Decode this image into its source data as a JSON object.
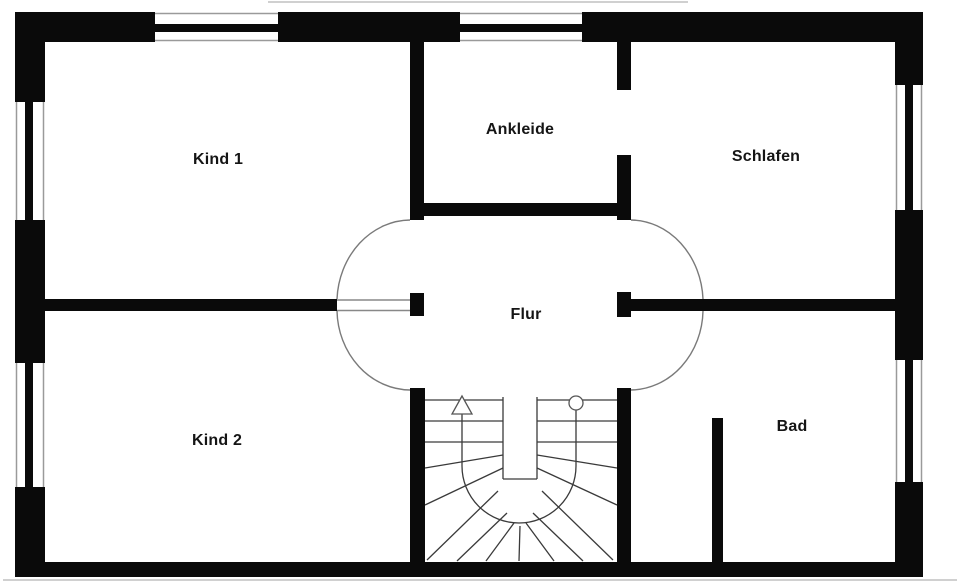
{
  "colors": {
    "wall": "#0a0a0a",
    "background": "#ffffff",
    "stair_line": "#3a3a3a",
    "arc_line": "#7a7a7a",
    "window_face": "#9a9a9a",
    "doorway_line": "#888888",
    "artifact": "#d0d0d0",
    "label": "#151515"
  },
  "rooms": [
    {
      "id": "kind-1",
      "label": "Kind 1",
      "cx": 218,
      "cy": 160
    },
    {
      "id": "ankleide",
      "label": "Ankleide",
      "cx": 520,
      "cy": 130
    },
    {
      "id": "schlafen",
      "label": "Schlafen",
      "cx": 766,
      "cy": 157
    },
    {
      "id": "flur",
      "label": "Flur",
      "cx": 526,
      "cy": 315
    },
    {
      "id": "kind-2",
      "label": "Kind 2",
      "cx": 217,
      "cy": 441
    },
    {
      "id": "bad",
      "label": "Bad",
      "cx": 792,
      "cy": 427
    }
  ],
  "walls": [
    {
      "id": "outer-top",
      "x": 15,
      "y": 12,
      "w": 908,
      "h": 30
    },
    {
      "id": "outer-left",
      "x": 15,
      "y": 12,
      "w": 30,
      "h": 565
    },
    {
      "id": "outer-right",
      "x": 895,
      "y": 12,
      "w": 28,
      "h": 565
    },
    {
      "id": "outer-bottom",
      "x": 15,
      "y": 562,
      "w": 908,
      "h": 15
    },
    {
      "id": "kind1-ankleide",
      "x": 410,
      "y": 42,
      "w": 14,
      "h": 178
    },
    {
      "id": "ankleide-schlafen-upper",
      "x": 617,
      "y": 42,
      "w": 14,
      "h": 48
    },
    {
      "id": "ankleide-schlafen-lower",
      "x": 617,
      "y": 155,
      "w": 14,
      "h": 65
    },
    {
      "id": "ankleide-bottom",
      "x": 424,
      "y": 203,
      "w": 207,
      "h": 13
    },
    {
      "id": "mid-left",
      "x": 45,
      "y": 299,
      "w": 292,
      "h": 12
    },
    {
      "id": "left-door-stub",
      "x": 410,
      "y": 293,
      "w": 14,
      "h": 23
    },
    {
      "id": "mid-right",
      "x": 617,
      "y": 299,
      "w": 278,
      "h": 12
    },
    {
      "id": "mid-right-endcap",
      "x": 617,
      "y": 292,
      "w": 14,
      "h": 25
    },
    {
      "id": "stairs-left",
      "x": 410,
      "y": 388,
      "w": 15,
      "h": 174
    },
    {
      "id": "stairs-right",
      "x": 617,
      "y": 388,
      "w": 14,
      "h": 174
    },
    {
      "id": "bad-stub",
      "x": 712,
      "y": 418,
      "w": 11,
      "h": 144
    }
  ],
  "windows": [
    {
      "id": "top-kind1",
      "opening": [
        155,
        12,
        123,
        30
      ],
      "bar": [
        155,
        24,
        123,
        8
      ],
      "faces": [
        [
          155,
          13.5,
          278,
          13.5
        ],
        [
          155,
          40.5,
          278,
          40.5
        ]
      ]
    },
    {
      "id": "top-ankleide",
      "opening": [
        460,
        12,
        122,
        30
      ],
      "bar": [
        460,
        24,
        122,
        8
      ],
      "faces": [
        [
          460,
          13.5,
          582,
          13.5
        ],
        [
          460,
          40.5,
          582,
          40.5
        ]
      ]
    },
    {
      "id": "left-kind1",
      "opening": [
        15,
        102,
        30,
        118
      ],
      "bar": [
        25,
        102,
        8,
        118
      ],
      "faces": [
        [
          16.5,
          102,
          16.5,
          220
        ],
        [
          43.5,
          102,
          43.5,
          220
        ]
      ]
    },
    {
      "id": "left-kind2",
      "opening": [
        15,
        363,
        30,
        124
      ],
      "bar": [
        25,
        363,
        8,
        124
      ],
      "faces": [
        [
          16.5,
          363,
          16.5,
          487
        ],
        [
          43.5,
          363,
          43.5,
          487
        ]
      ]
    },
    {
      "id": "right-schlafen",
      "opening": [
        895,
        85,
        28,
        125
      ],
      "bar": [
        905,
        85,
        8,
        125
      ],
      "faces": [
        [
          896.5,
          85,
          896.5,
          210
        ],
        [
          921.5,
          85,
          921.5,
          210
        ]
      ]
    },
    {
      "id": "right-bad",
      "opening": [
        895,
        360,
        28,
        122
      ],
      "bar": [
        905,
        360,
        8,
        122
      ],
      "faces": [
        [
          896.5,
          360,
          896.5,
          482
        ],
        [
          921.5,
          360,
          921.5,
          482
        ]
      ]
    }
  ],
  "doorway_lines": [
    [
      337,
      300,
      410,
      300
    ],
    [
      337,
      310.5,
      410,
      310.5
    ]
  ],
  "door_arcs": [
    {
      "id": "flur-top-left",
      "path": "M 410 220 A 74 83 0 0 0 337 299"
    },
    {
      "id": "flur-bottom-left",
      "path": "M 337 311 A 74 81 0 0 0 410 390"
    },
    {
      "id": "flur-top-right",
      "path": "M 631 220 A 73 83 0 0 1 703 299"
    },
    {
      "id": "flur-bottom-right",
      "path": "M 703 311 A 73 81 0 0 1 631 390"
    }
  ],
  "stairs": {
    "lines": [
      [
        425,
        400,
        503,
        400
      ],
      [
        537,
        400,
        617,
        400
      ],
      [
        425,
        421,
        503,
        421
      ],
      [
        425,
        442,
        503,
        442
      ],
      [
        537,
        421,
        617,
        421
      ],
      [
        537,
        442,
        617,
        442
      ],
      [
        503,
        397,
        503,
        479
      ],
      [
        537,
        397,
        537,
        479
      ],
      [
        503,
        479,
        537,
        479
      ],
      [
        503,
        455,
        425,
        468
      ],
      [
        503,
        468,
        425,
        505
      ],
      [
        498,
        491,
        427,
        560
      ],
      [
        507,
        513,
        457,
        561
      ],
      [
        514,
        523,
        486,
        561
      ],
      [
        520,
        526,
        519,
        561
      ],
      [
        537,
        455,
        617,
        468
      ],
      [
        537,
        468,
        617,
        505
      ],
      [
        542,
        491,
        613,
        560
      ],
      [
        533,
        513,
        583,
        561
      ],
      [
        526,
        523,
        554,
        561
      ]
    ],
    "walk_line_path": "M 462 413 L 462 466 A 57 57 0 0 0 576 466 L 576 410",
    "arrow_points": "462,396 452,414 472,414",
    "circle": {
      "cx": 576,
      "cy": 403,
      "r": 7
    }
  },
  "artifact_lines": [
    [
      268,
      2,
      688,
      2
    ],
    [
      3,
      580,
      957,
      580
    ]
  ]
}
